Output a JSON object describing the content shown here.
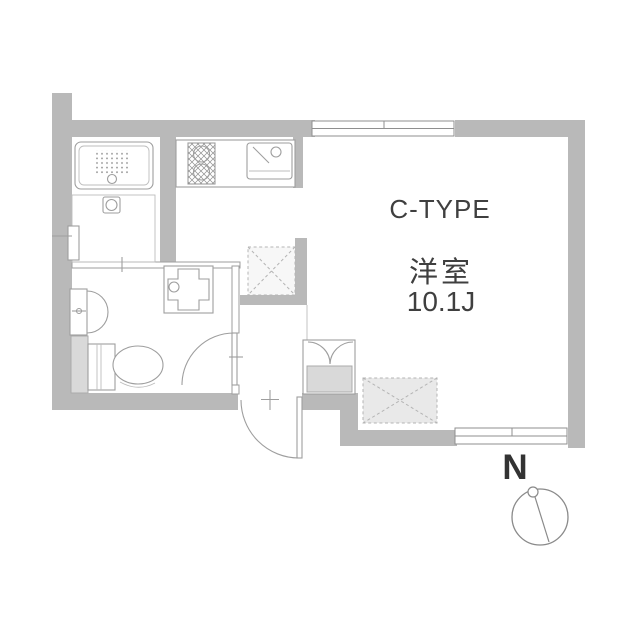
{
  "labels": {
    "type": "C-TYPE",
    "room": "洋室",
    "size": "10.1J",
    "compass": "N"
  },
  "colors": {
    "background": "#ffffff",
    "wall": "#b9b9b9",
    "fixture_line": "#9e9e9e",
    "cabinet_fill": "#d9d9d9",
    "storage_fill": "#e9e9e9",
    "refrigerator_fill": "#f7f7f7",
    "text": "#3f3f3f"
  },
  "fixtures": [
    "bathtub",
    "shower-room",
    "washbasin",
    "toilet",
    "pipe-space",
    "washing-machine-pan",
    "kitchen-counter",
    "gas-stove",
    "kitchen-sink",
    "refrigerator-space",
    "shoe-cabinet",
    "storage-space",
    "entrance-door",
    "washroom-door",
    "sliding-window-top",
    "sliding-window-bottom",
    "compass"
  ]
}
